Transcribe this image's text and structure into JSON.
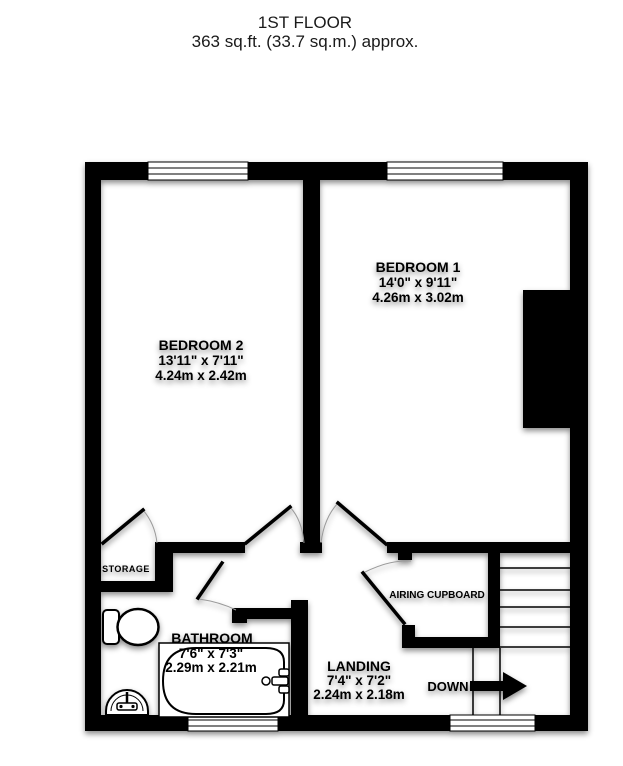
{
  "title": {
    "floor": "1ST FLOOR",
    "area": "363 sq.ft. (33.7 sq.m.) approx."
  },
  "rooms": {
    "bedroom1": {
      "name": "BEDROOM 1",
      "imperial": "14'0\"  x 9'11\"",
      "metric": "4.26m  x 3.02m"
    },
    "bedroom2": {
      "name": "BEDROOM 2",
      "imperial": "13'11\"  x 7'11\"",
      "metric": "4.24m  x 2.42m"
    },
    "bathroom": {
      "name": "BATHROOM",
      "imperial": "7'6\"  x 7'3\"",
      "metric": "2.29m  x 2.21m"
    },
    "landing": {
      "name": "LANDING",
      "imperial": "7'4\"  x 7'2\"",
      "metric": "2.24m  x 2.18m"
    },
    "storage": {
      "name": "STORAGE"
    },
    "airing_cupboard": {
      "name": "AIRING CUPBOARD"
    }
  },
  "annotations": {
    "down": "DOWN"
  },
  "colors": {
    "wall": "#000000",
    "background": "#ffffff",
    "door_arc": "#9a9a9a",
    "text": "#000000"
  }
}
